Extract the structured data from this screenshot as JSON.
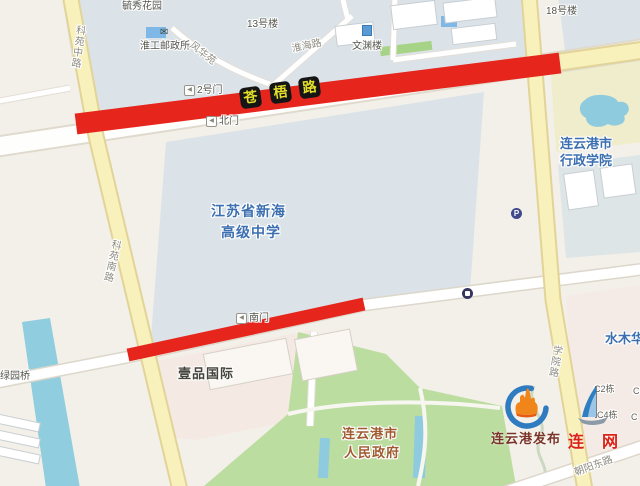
{
  "roads": {
    "cangwu_chars": [
      "苍",
      "梧",
      "路"
    ],
    "keyuan_middle": "科苑中路",
    "keyuan_south": "科苑南路",
    "huaihai": "淮海路",
    "xueyuan": "学院路",
    "chaoyang_east": "朝阳东路"
  },
  "pois": {
    "yuxiu_garden": "毓秀花园",
    "building_13": "13号楼",
    "building_18": "18号楼",
    "post_office": "淮工邮政所",
    "fenghua_yuan": "风华苑",
    "wenyuan_building": "文渊楼",
    "gate_2": "2号门",
    "gate_north": "北门",
    "gate_south": "南门",
    "school_line1": "江苏省新海",
    "school_line2": "高级中学",
    "college_line1": "连云港市",
    "college_line2": "行政学院",
    "yipin_intl": "壹品国际",
    "gov_line1": "连云港市",
    "gov_line2": "人民政府",
    "shuimuhua": "水木华",
    "c2": "C2栋",
    "c4": "C4栋",
    "c_partial_1": "C",
    "c_partial_2": "C",
    "lvyuan_bridge": "绿园桥"
  },
  "icons": {
    "gate_arrow": "◀",
    "parking": "P",
    "envelope": "✉"
  },
  "watermarks": {
    "lyg_fabu": "连云港发布",
    "lianwang": "连 网"
  },
  "colors": {
    "closure_red": "#E6251C",
    "badge_bg": "#151515",
    "badge_text": "#E3DF2A",
    "water": "#90CEDF",
    "park_green": "#BCDDA0",
    "campus_blue_gray": "#DBE3E9",
    "yellow_road": "#F8F1BB",
    "poi_blue": "#3C6FB0",
    "gov_brown": "#A05A30",
    "brand_blue": "#2E7BC0",
    "brand_orange": "#F08519",
    "brand_red": "#DC2217"
  }
}
